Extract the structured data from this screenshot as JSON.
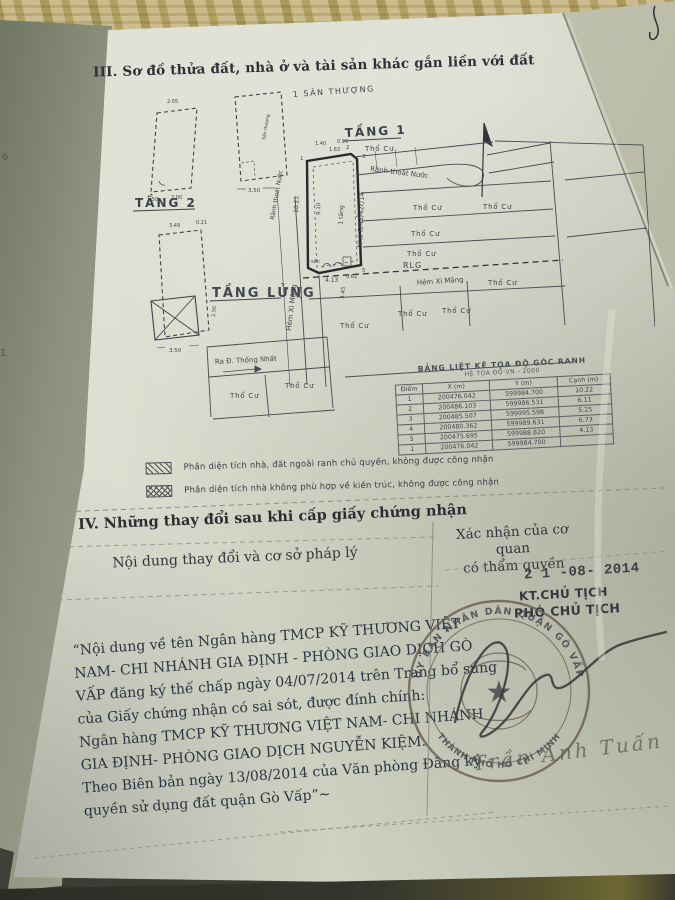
{
  "section3": {
    "heading": "III. Sơ đồ thửa đất, nhà ở và tài sản khác gắn liền với đất",
    "diagram": {
      "floor_labels": {
        "san_thuong": "1 SÂN THƯỢNG",
        "san_thuong_inner": "Sân thượng",
        "tang1": "TẦNG 1",
        "tang2": "TẦNG 2",
        "tang_lung": "TẦNG LỬNG"
      },
      "site_labels": {
        "tho_cu": "Thổ Cư",
        "ranh_thoat_nuoc": "Rãnh thoát Nước",
        "hem_xi_mang": "Hẻm Xi Măng",
        "ra_duong": "Ra Đ. Thống Nhất",
        "rlg": "RLG",
        "nha": "Nhà G/42/42c/14",
        "mot_tang": "1 tầng",
        "san": "sân"
      },
      "dims": {
        "a350": "3.50",
        "b350": "3.50",
        "v1022": "10.22",
        "v413": "4.13",
        "v062": "0.62",
        "v163": "1.63",
        "v021": "0.21",
        "v910": "9.10",
        "v298": "2.98",
        "v345": "3.45",
        "v150": "1.50",
        "v200": "2.00",
        "v205": "2.05",
        "v349": "3.49",
        "v250": "2.50",
        "v140": "1.40",
        "v095": "0.95"
      },
      "point_labels": [
        "1",
        "2",
        "3",
        "4",
        "5"
      ]
    },
    "coord_table": {
      "title": "BẢNG LIỆT KÊ TỌA ĐỘ GÓC RANH",
      "subtitle": "HỆ TỌA ĐỘ VN - 2000",
      "headers": [
        "Điểm",
        "X (m)",
        "Y (m)",
        "Cạnh (m)"
      ],
      "rows": [
        [
          "1",
          "200476.042",
          "599984.700",
          "10.22"
        ],
        [
          "2",
          "200486.103",
          "599986.531",
          "6.11"
        ],
        [
          "3",
          "200485.507",
          "599995.598",
          "5.25"
        ],
        [
          "4",
          "200480.362",
          "599989.631",
          "6.73"
        ],
        [
          "5",
          "200475.695",
          "599988.820",
          "4.13"
        ],
        [
          "1",
          "200476.042",
          "599984.700",
          ""
        ]
      ]
    },
    "legend": {
      "item1": "Phần diện tích nhà, đất ngoài ranh chủ quyền, không được công nhận",
      "item2": "Phần diện tích nhà không phù hợp về kiến trúc, không được công nhận"
    }
  },
  "section4": {
    "heading": "IV. Những thay đổi sau khi cấp giấy chứng nhận",
    "left_header": "Nội dung thay đổi và cơ sở pháp lý",
    "right_header_line1": "Xác nhận của cơ quan",
    "right_header_line2": "có thẩm quyền",
    "date_stamp": "2 1 -08- 2014",
    "approver_title1": "KT.CHỦ TỊCH",
    "approver_title2": "PHÓ CHỦ TỊCH",
    "entry_lines": [
      "“Nội dung về tên Ngân hàng TMCP KỸ THƯƠNG VIỆT",
      "NAM- CHI NHÁNH GIA ĐỊNH - PHÒNG GIAO DỊCH GÒ",
      "VẤP đăng ký thế chấp ngày 04/07/2014 trên Trang bổ sung",
      "của Giấy chứng nhận có sai sót, được đính chính:",
      "Ngân hàng TMCP KỸ THƯƠNG VIỆT NAM- CHI NHÁNH",
      "GIA ĐỊNH- PHÒNG GIAO DỊCH NGUYỄN KIỆM.",
      "Theo Biên bản ngày 13/08/2014 của Văn phòng Đăng ký",
      "quyền sử dụng đất quận Gò Vấp”~"
    ],
    "seal": {
      "top": "ỦY BAN NHÂN DÂN QUẬN GÒ VẤP",
      "bottom": "THÀNH PHỐ HỒ CHÍ MINH"
    },
    "signature_name": "Trần Anh Tuấn"
  },
  "under_page_fragments": {
    "f1": "6",
    "f2": "1"
  }
}
